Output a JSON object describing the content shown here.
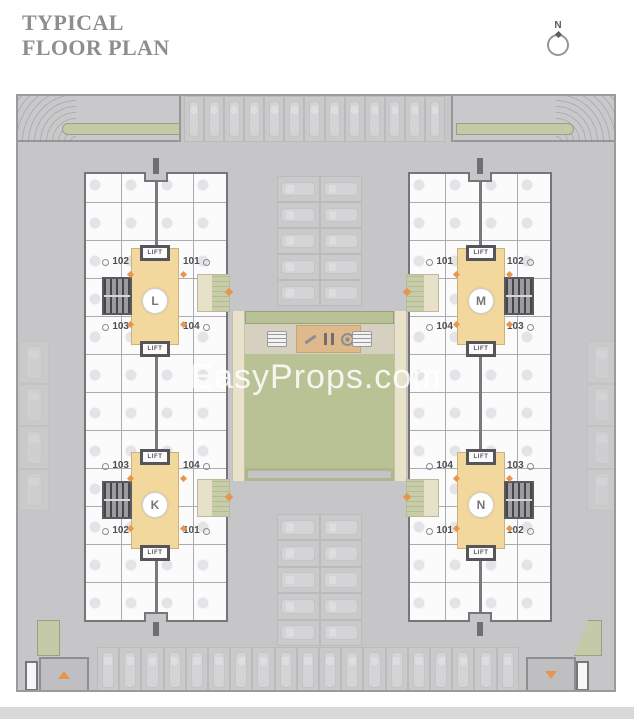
{
  "title": {
    "line1": "TYPICAL",
    "line2": "FLOOR PLAN"
  },
  "compass": {
    "label": "N"
  },
  "watermark": {
    "text": "EasyProps.com"
  },
  "labels": {
    "lift": "LIFT"
  },
  "towers": [
    {
      "name": "L",
      "position": "top-left",
      "units": {
        "top_left": "102",
        "top_right": "101",
        "bottom_left": "103",
        "bottom_right": "104"
      }
    },
    {
      "name": "M",
      "position": "top-right",
      "units": {
        "top_left": "101",
        "top_right": "102",
        "bottom_left": "104",
        "bottom_right": "103"
      }
    },
    {
      "name": "K",
      "position": "bottom-left",
      "units": {
        "top_left": "103",
        "top_right": "104",
        "bottom_left": "102",
        "bottom_right": "101"
      }
    },
    {
      "name": "N",
      "position": "bottom-right",
      "units": {
        "top_left": "104",
        "top_right": "103",
        "bottom_left": "101",
        "bottom_right": "102"
      }
    }
  ],
  "colors": {
    "lobby": "#f3d89d",
    "lawn": "#b9c295",
    "walkway_green": "#c4caa7",
    "amenity_tan": "#ddb98b",
    "accent_orange": "#e8954f",
    "plan_bg": "#c6c6c8",
    "title_gray": "#8e8e92"
  }
}
